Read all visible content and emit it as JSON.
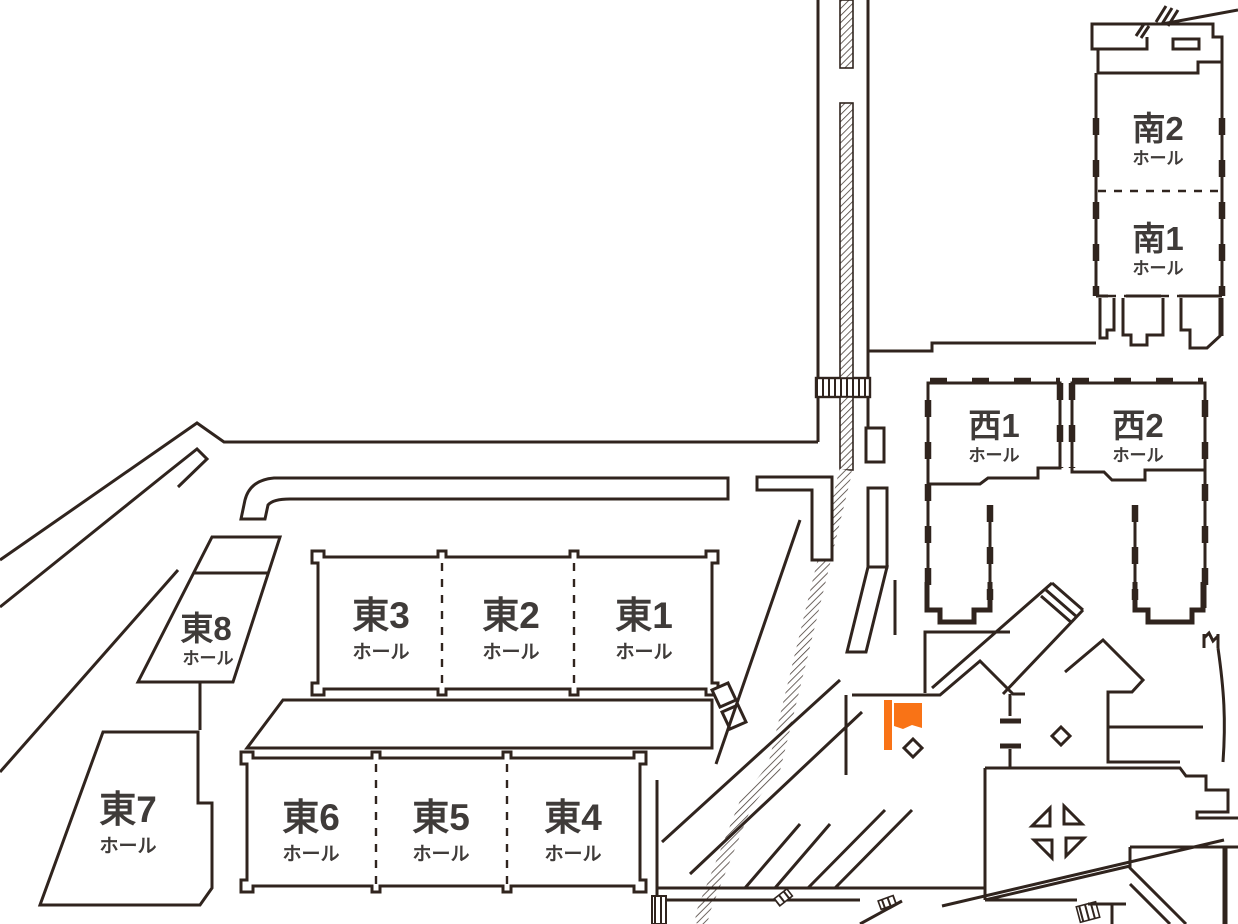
{
  "map_name": "exhibition-halls-floor-map",
  "colors": {
    "line": "#30241E",
    "text": "#3F3B39",
    "marker_orange": "#F97316"
  },
  "halls": {
    "east1": {
      "label": "東1",
      "sub": "ホール"
    },
    "east2": {
      "label": "東2",
      "sub": "ホール"
    },
    "east3": {
      "label": "東3",
      "sub": "ホール"
    },
    "east4": {
      "label": "東4",
      "sub": "ホール"
    },
    "east5": {
      "label": "東5",
      "sub": "ホール"
    },
    "east6": {
      "label": "東6",
      "sub": "ホール"
    },
    "east7": {
      "label": "東7",
      "sub": "ホール"
    },
    "east8": {
      "label": "東8",
      "sub": "ホール"
    },
    "west1": {
      "label": "西1",
      "sub": "ホール"
    },
    "west2": {
      "label": "西2",
      "sub": "ホール"
    },
    "south1": {
      "label": "南1",
      "sub": "ホール"
    },
    "south2": {
      "label": "南2",
      "sub": "ホール"
    }
  },
  "marker": {
    "type": "flag",
    "color": "#F97316"
  }
}
